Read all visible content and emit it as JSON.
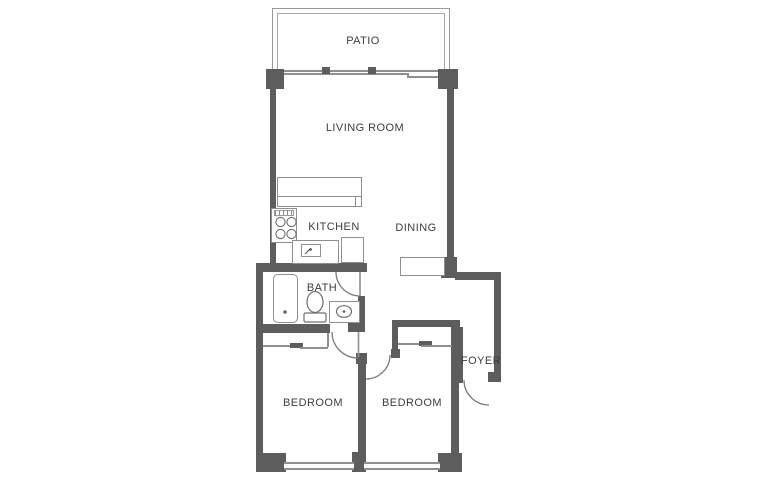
{
  "rooms": [
    {
      "name": "patio",
      "label": "PATIO"
    },
    {
      "name": "living-room",
      "label": "LIVING ROOM"
    },
    {
      "name": "kitchen",
      "label": "KITCHEN"
    },
    {
      "name": "dining",
      "label": "DINING"
    },
    {
      "name": "bath",
      "label": "BATH"
    },
    {
      "name": "foyer",
      "label": "FOYER"
    },
    {
      "name": "bedroom-left",
      "label": "BEDROOM"
    },
    {
      "name": "bedroom-right",
      "label": "BEDROOM"
    }
  ],
  "colors": {
    "wall": "#5d5d5d",
    "thin_line": "#8f8f8f",
    "door_arc": "#7a7a7a",
    "text": "#3d3d3d",
    "background": "#ffffff"
  },
  "fixtures": [
    "patio-railing",
    "sliding-glass-door",
    "bar-counter",
    "stove",
    "kitchen-sink",
    "refrigerator",
    "hall-closet",
    "bathtub",
    "toilet",
    "vanity-sink",
    "bedroom-closet-left",
    "bedroom-closet-right",
    "bath-door",
    "bedroom-left-door",
    "bedroom-right-door",
    "entry-door",
    "window-left",
    "window-right"
  ]
}
